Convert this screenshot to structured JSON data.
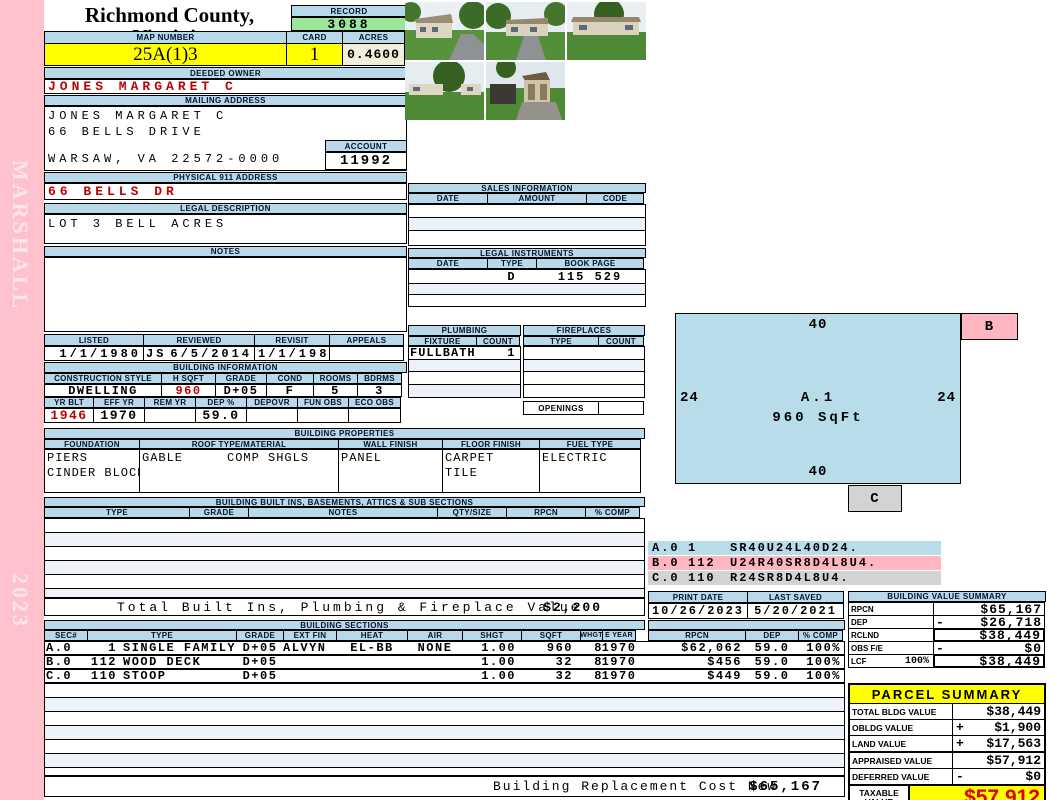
{
  "sidebar": {
    "vendor": "MARSHALL",
    "year": "2023"
  },
  "header": {
    "county": "Richmond County, Virginia",
    "commissioner": "Commissioner of the Revenue, PO Box 366, Warsaw, VA 22572",
    "record_label": "RECORD",
    "record_value": "3088",
    "map_number_label": "MAP NUMBER",
    "map_number": "25A(1)3",
    "card_label": "CARD",
    "card": "1",
    "acres_label": "ACRES",
    "acres": "0.4600"
  },
  "owner": {
    "deeded_owner_label": "DEEDED OWNER",
    "deeded_owner": "JONES MARGARET C",
    "mailing_address_label": "MAILING ADDRESS",
    "mailing_name": "JONES MARGARET C",
    "mailing_street": "66 BELLS DRIVE",
    "mailing_city": "WARSAW, VA 22572-0000",
    "account_label": "ACCOUNT",
    "account": "11992",
    "physical_address_label": "PHYSICAL 911 ADDRESS",
    "physical_address": "66 BELLS DR",
    "legal_description_label": "LEGAL DESCRIPTION",
    "legal_description": "LOT 3 BELL ACRES",
    "notes_label": "NOTES"
  },
  "review": {
    "listed_label": "LISTED",
    "listed": "1/1/1980",
    "reviewed_label": "REVIEWED",
    "reviewed_by": "JS",
    "reviewed_date": "6/5/2014",
    "revisit_label": "REVISIT",
    "revisit": "1/1/1980",
    "appeals_label": "APPEALS",
    "appeals": ""
  },
  "building_info": {
    "title": "BUILDING INFORMATION",
    "style_label": "CONSTRUCTION STYLE",
    "style": "DWELLING",
    "hsqft_label": "H SQFT",
    "hsqft": "960",
    "grade_label": "GRADE",
    "grade": "D+05",
    "cond_label": "COND",
    "cond": "F",
    "rooms_label": "ROOMS",
    "rooms": "5",
    "bdrms_label": "BDRMS",
    "bdrms": "3",
    "yrblt_label": "YR BLT",
    "yrblt": "1946",
    "effyr_label": "EFF YR",
    "effyr": "1970",
    "remyr_label": "REM YR",
    "remyr": "",
    "dep_label": "DEP %",
    "dep": "59.0",
    "depovr_label": "DEPOVR",
    "depovr": "",
    "funobs_label": "FUN OBS",
    "funobs": "",
    "ecoobs_label": "ECO OBS",
    "ecoobs": ""
  },
  "sales": {
    "title": "SALES INFORMATION",
    "date_label": "DATE",
    "amount_label": "AMOUNT",
    "code_label": "CODE"
  },
  "legal_instruments": {
    "title": "LEGAL INSTRUMENTS",
    "date_label": "DATE",
    "type_label": "TYPE",
    "bookpage_label": "BOOK PAGE",
    "row_type": "D",
    "row_bookpage": "115 529"
  },
  "plumbing": {
    "title": "PLUMBING",
    "fixture_label": "FIXTURE",
    "count_label": "COUNT",
    "fixture": "FULLBATH",
    "count": "1"
  },
  "fireplaces": {
    "title": "FIREPLACES",
    "type_label": "TYPE",
    "count_label": "COUNT",
    "openings_label": "OPENINGS"
  },
  "properties": {
    "title": "BUILDING PROPERTIES",
    "foundation_label": "FOUNDATION",
    "foundation_1": "PIERS",
    "foundation_2": "CINDER BLOCK",
    "roof_label": "ROOF TYPE/MATERIAL",
    "roof_type": "GABLE",
    "roof_material": "COMP SHGLS",
    "wall_label": "WALL FINISH",
    "wall": "PANEL",
    "floor_label": "FLOOR FINISH",
    "floor_1": "CARPET",
    "floor_2": "TILE",
    "fuel_label": "FUEL TYPE",
    "fuel": "ELECTRIC"
  },
  "built_ins": {
    "title": "BUILDING BUILT INS, BASEMENTS, ATTICS & SUB SECTIONS",
    "type_label": "TYPE",
    "grade_label": "GRADE",
    "notes_label": "NOTES",
    "qty_label": "QTY/SIZE",
    "rpcn_label": "RPCN",
    "comp_label": "% COMP",
    "total_label": "Total Built Ins, Plumbing & Fireplace Value",
    "total_value": "$2,200"
  },
  "sketch": {
    "dim_top": "40",
    "dim_bottom": "40",
    "dim_left": "24",
    "dim_right": "24",
    "area_label": "A.1",
    "area_sqft": "960 SqFt",
    "b_label": "B",
    "c_label": "C",
    "legend": [
      {
        "sec": "A.0",
        "code": "1",
        "trace": "SR40U24L40D24."
      },
      {
        "sec": "B.0",
        "code": "112",
        "trace": "U24R40SR8D4L8U4."
      },
      {
        "sec": "C.0",
        "code": "110",
        "trace": "R24SR8D4L8U4."
      }
    ]
  },
  "print_info": {
    "print_date_label": "PRINT DATE",
    "print_date": "10/26/2023",
    "last_saved_label": "LAST SAVED",
    "last_saved": "5/20/2021"
  },
  "value_summary": {
    "title": "BUILDING VALUE SUMMARY",
    "rows": [
      {
        "label": "RPCN",
        "pct": "",
        "op": "",
        "value": "$65,167"
      },
      {
        "label": "DEP",
        "pct": "",
        "op": "-",
        "value": "$26,718"
      },
      {
        "label": "RCLND",
        "pct": "",
        "op": "",
        "value": "$38,449"
      },
      {
        "label": "OBS F/E",
        "pct": "",
        "op": "-",
        "value": "$0"
      },
      {
        "label": "LCF",
        "pct": "100%",
        "op": "",
        "value": "$38,449"
      }
    ]
  },
  "building_sections": {
    "title": "BUILDING SECTIONS",
    "col_sec": "SEC#",
    "col_type": "TYPE",
    "col_grade": "GRADE",
    "col_extfin": "EXT FIN",
    "col_heat": "HEAT",
    "col_air": "AIR",
    "col_shgt": "SHGT",
    "col_sqft": "SQFT",
    "col_whgt": "WHGT",
    "col_eyear": "E YEAR",
    "col_rpcn": "RPCN",
    "col_dep": "DEP",
    "col_comp": "% COMP",
    "rows": [
      {
        "sec": "A.0",
        "code": "1",
        "type": "SINGLE FAMILY",
        "grade": "D+05",
        "extfin": "ALVYN",
        "heat": "EL-BB",
        "air": "NONE",
        "shgt": "1.00",
        "sqft": "960",
        "whgt": "8",
        "eyear": "1970",
        "rpcn": "$62,062",
        "dep": "59.0",
        "comp": "100%"
      },
      {
        "sec": "B.0",
        "code": "112",
        "type": "WOOD DECK",
        "grade": "D+05",
        "extfin": "",
        "heat": "",
        "air": "",
        "shgt": "1.00",
        "sqft": "32",
        "whgt": "8",
        "eyear": "1970",
        "rpcn": "$456",
        "dep": "59.0",
        "comp": "100%"
      },
      {
        "sec": "C.0",
        "code": "110",
        "type": "STOOP",
        "grade": "D+05",
        "extfin": "",
        "heat": "",
        "air": "",
        "shgt": "1.00",
        "sqft": "32",
        "whgt": "8",
        "eyear": "1970",
        "rpcn": "$449",
        "dep": "59.0",
        "comp": "100%"
      }
    ],
    "footer_label": "Building Replacement Cost New",
    "footer_value": "$65,167"
  },
  "parcel_summary": {
    "title": "PARCEL SUMMARY",
    "rows": [
      {
        "label": "TOTAL BLDG VALUE",
        "op": "",
        "value": "$38,449"
      },
      {
        "label": "OBLDG VALUE",
        "op": "+",
        "value": "$1,900"
      },
      {
        "label": "LAND VALUE",
        "op": "+",
        "value": "$17,563"
      },
      {
        "label": "APPRAISED VALUE",
        "op": "",
        "value": "$57,912"
      },
      {
        "label": "DEFERRED VALUE",
        "op": "-",
        "value": "$0"
      }
    ],
    "taxable_label": "TAXABLE VALUE",
    "taxable_value": "$57,912"
  },
  "colors": {
    "header_blue": "#b7d9e9",
    "record_green": "#9ce69c",
    "highlight_yellow": "#ffff00",
    "acres_cream": "#f1eedb",
    "alert_red": "#cc0000",
    "sidebar_pink": "#ffc2cc",
    "sketch_blue": "#b8dcea",
    "sketch_pink": "#ffb6c1",
    "sketch_gray": "#d3d3d3"
  }
}
